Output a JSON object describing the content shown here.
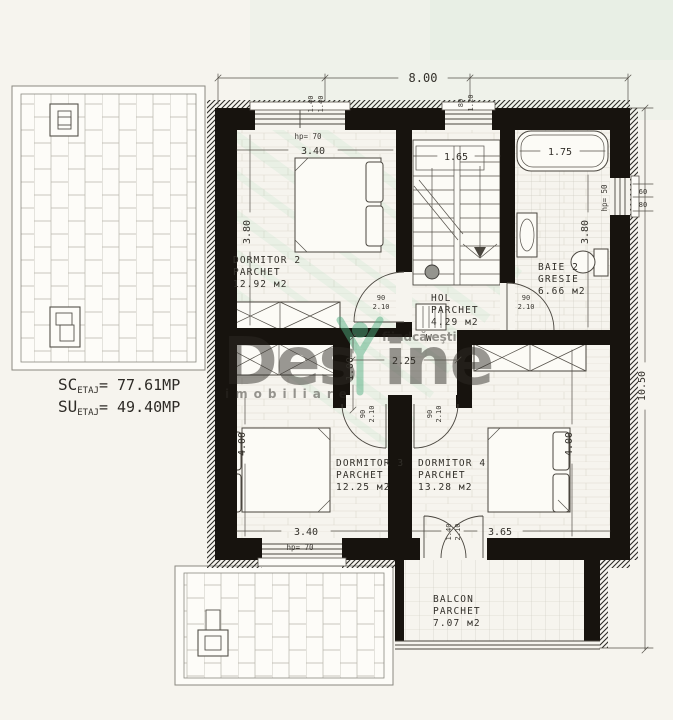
{
  "summary": {
    "sc": "SC",
    "sc_sub": "ETAJ",
    "sc_val": "= 77.61MP",
    "su": "SU",
    "su_sub": "ETAJ",
    "su_val": "= 49.40MP"
  },
  "watermark": {
    "brand_a": "Des",
    "brand_b": "ine",
    "tagline": "fiindcă eşti",
    "subtitle": "imobiliare",
    "color": "#5fbd8e"
  },
  "dims": {
    "total_w": "8.00",
    "total_h": "10.50",
    "hall_l": "2.25",
    "hall_w": "1.00",
    "stair_w": "1.65"
  },
  "windows": {
    "w1_w": "1.40",
    "w1_h": "1.40",
    "w2_w": "80",
    "w2_h": "1.20",
    "d2_hp": "hp= 70",
    "d3_hp": "hp= 70",
    "bath_hp": "hp= 50",
    "bath_w": "60",
    "bath_h": "80"
  },
  "doors": {
    "d2_w": "90",
    "d2_h": "2.10",
    "baie_w": "90",
    "baie_h": "2.10",
    "d3_w": "90",
    "d3_h": "2.10",
    "d4_w": "90",
    "d4_h": "2.10",
    "balcon_w": "1.40",
    "balcon_h": "2.10"
  },
  "rooms": {
    "d2": {
      "name": "DORMITOR 2",
      "finish": "PARCHET",
      "area": "12.92 м2",
      "w": "3.40",
      "h": "3.80"
    },
    "baie": {
      "name": "BAIE 2",
      "finish": "GRESIE",
      "area": "6.66 м2",
      "tub": "1.75",
      "h": "3.80"
    },
    "hol": {
      "name": "HOL",
      "finish": "PARCHET",
      "area": "4.29 м2"
    },
    "d3": {
      "name": "DORMITOR 3",
      "finish": "PARCHET",
      "area": "12.25 м2",
      "w": "3.40",
      "h": "4.00"
    },
    "d4": {
      "name": "DORMITOR 4",
      "finish": "PARCHET",
      "area": "13.28 м2",
      "w": "3.65",
      "h": "4.00"
    },
    "balcon": {
      "name": "BALCON",
      "finish": "PARCHET",
      "area": "7.07 м2"
    }
  },
  "appliances": {
    "washer": "W"
  },
  "colors": {
    "wall": "#17130e",
    "paper": "#f6f4ee",
    "line": "#3c3a36"
  }
}
